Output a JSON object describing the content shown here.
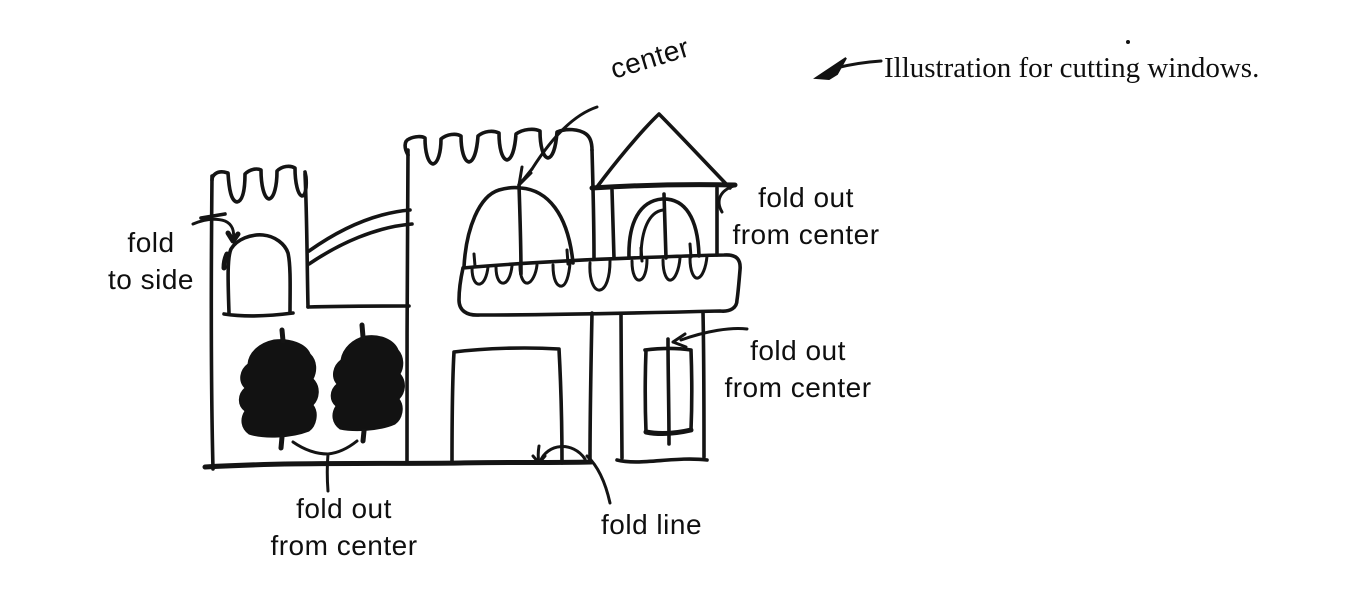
{
  "page": {
    "background": "#ffffff",
    "ink_color": "#141414"
  },
  "caption": {
    "text": "Illustration for cutting windows."
  },
  "annotations": {
    "center": {
      "text": "center"
    },
    "fold_to_side": {
      "line1": "fold",
      "line2": "to side"
    },
    "fold_out_upper_right": {
      "line1": "fold out",
      "line2": "from center"
    },
    "fold_out_lower_right": {
      "line1": "fold out",
      "line2": "from center"
    },
    "fold_out_bottom": {
      "line1": "fold out",
      "line2": "from center"
    },
    "fold_line": {
      "text": "fold line"
    }
  },
  "icons": {
    "caption_arrow": "left-arrow",
    "center_arrow": "curved-arrow-to-dome-center",
    "fold_to_side_arrow": "curved-arrow-into-window",
    "fold_out_upper_arrow": "curved-hook-arrow",
    "fold_out_lower_arrow": "curved-arrow-left",
    "fold_line_arrow": "curved-arrow-with-arc",
    "bottom_connector": "y-shaped-connector"
  },
  "figure": {
    "subject": "hand-drawn castle sketch for paper window cutting",
    "parts": [
      "left tower with battlements and arched window",
      "two blacked-in arched windows",
      "main wall with battlements, dome window and square door",
      "crenellated balcony band",
      "right tower with triangular roof and arched opening",
      "lower right tower with rectangular window",
      "ground line"
    ]
  }
}
